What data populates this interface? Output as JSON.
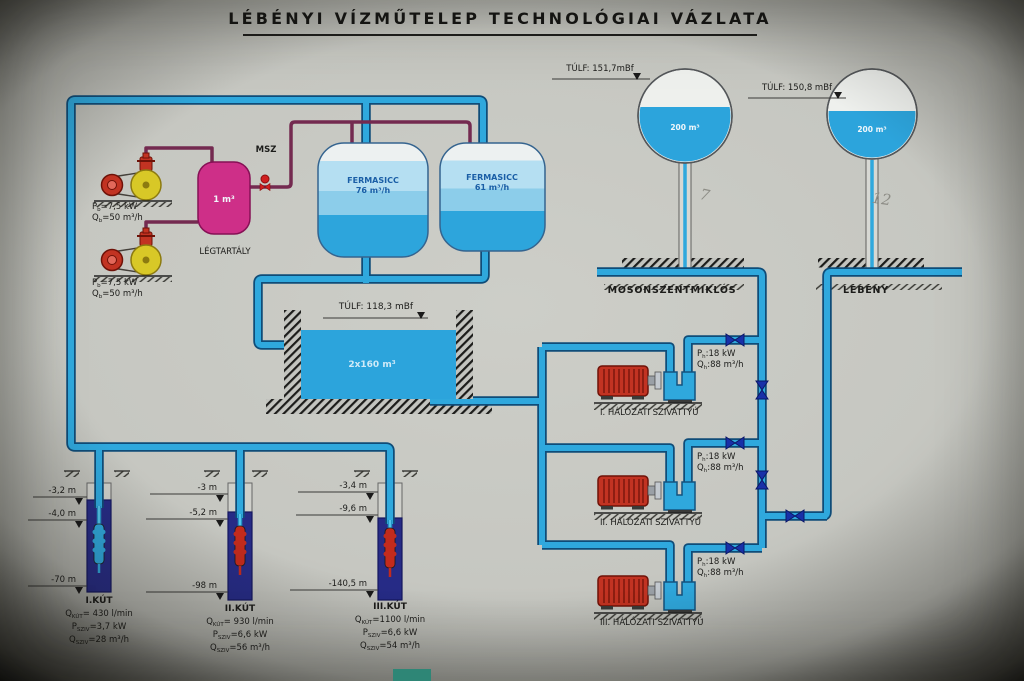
{
  "title": "LÉBÉNYI VÍZMŰTELEP TECHNOLÓGIAI VÁZLATA",
  "air_system": {
    "msz_label": "MSZ",
    "tank_volume": "1 m³",
    "tank_label": "LÉGTARTÁLY",
    "compressor1": {
      "p_sym": "P",
      "p_sub": "b",
      "p_val": "=7,5 kW",
      "q_sym": "Q",
      "q_sub": "b",
      "q_val": "=50 m³/h"
    },
    "compressor2": {
      "p_sym": "P",
      "p_sub": "b",
      "p_val": "=7,5 kW",
      "q_sym": "Q",
      "q_sub": "b",
      "q_val": "=50 m³/h"
    }
  },
  "filters": {
    "tank1": {
      "name": "FERMASICC",
      "capacity": "76 m³/h"
    },
    "tank2": {
      "name": "FERMASICC",
      "capacity": "61 m³/h"
    }
  },
  "reservoir": {
    "overflow": "TÚLF: 118,3 mBf",
    "volume": "2x160 m³"
  },
  "towers": {
    "tower1": {
      "overflow": "TÚLF: 151,7mBf",
      "volume": "200 m³",
      "name": "MOSONSZENTMIKLÓS",
      "note": "7"
    },
    "tower2": {
      "overflow": "TÚLF: 150,8 mBf",
      "volume": "200 m³",
      "name": "LÉBÉNY",
      "note": "12"
    }
  },
  "network_pumps": {
    "pump1": {
      "label": "I. HÁLÓZATI SZIVATTYÚ",
      "p_sym": "P",
      "p_sub": "h",
      "p_val": ":18 kW",
      "q_sym": "Q",
      "q_sub": "h",
      "q_val": ":88 m³/h"
    },
    "pump2": {
      "label": "II. HÁLÓZATI SZIVATTYÚ",
      "p_sym": "P",
      "p_sub": "h",
      "p_val": ":18 kW",
      "q_sym": "Q",
      "q_sub": "h",
      "q_val": ":88 m³/h"
    },
    "pump3": {
      "label": "III. HÁLÓZATI SZIVATTYÚ",
      "p_sym": "P",
      "p_sub": "h",
      "p_val": ":18 kW",
      "q_sym": "Q",
      "q_sub": "h",
      "q_val": ":88 m³/h"
    }
  },
  "wells": {
    "well1": {
      "name": "I.KÚT",
      "depths": [
        "-3,2 m",
        "-4,0 m",
        "-70 m"
      ],
      "q_sym": "Q",
      "q_sub": "KÚT",
      "q_val": "= 430 l/min",
      "p_sym": "P",
      "p_sub": "SZIV",
      "p_val": "=3,7 kW",
      "c_sym": "Q",
      "c_sub": "SZIV",
      "c_val": "=28 m³/h"
    },
    "well2": {
      "name": "II.KÚT",
      "depths": [
        "-3 m",
        "-5,2 m",
        "-98 m"
      ],
      "q_sym": "Q",
      "q_sub": "KÚT",
      "q_val": "= 930 l/min",
      "p_sym": "P",
      "p_sub": "SZIV",
      "p_val": "=6,6 kW",
      "c_sym": "Q",
      "c_sub": "SZIV",
      "c_val": "=56 m³/h"
    },
    "well3": {
      "name": "III.KÚT",
      "depths": [
        "-3,4 m",
        "-9,6 m",
        "-140,5 m"
      ],
      "q_sym": "Q",
      "q_sub": "KÚT",
      "q_val": "=1100 l/min",
      "p_sym": "P",
      "p_sub": "SZIV",
      "p_val": "=6,6 kW",
      "c_sym": "Q",
      "c_sub": "SZIV",
      "c_val": "=54 m³/h"
    }
  }
}
